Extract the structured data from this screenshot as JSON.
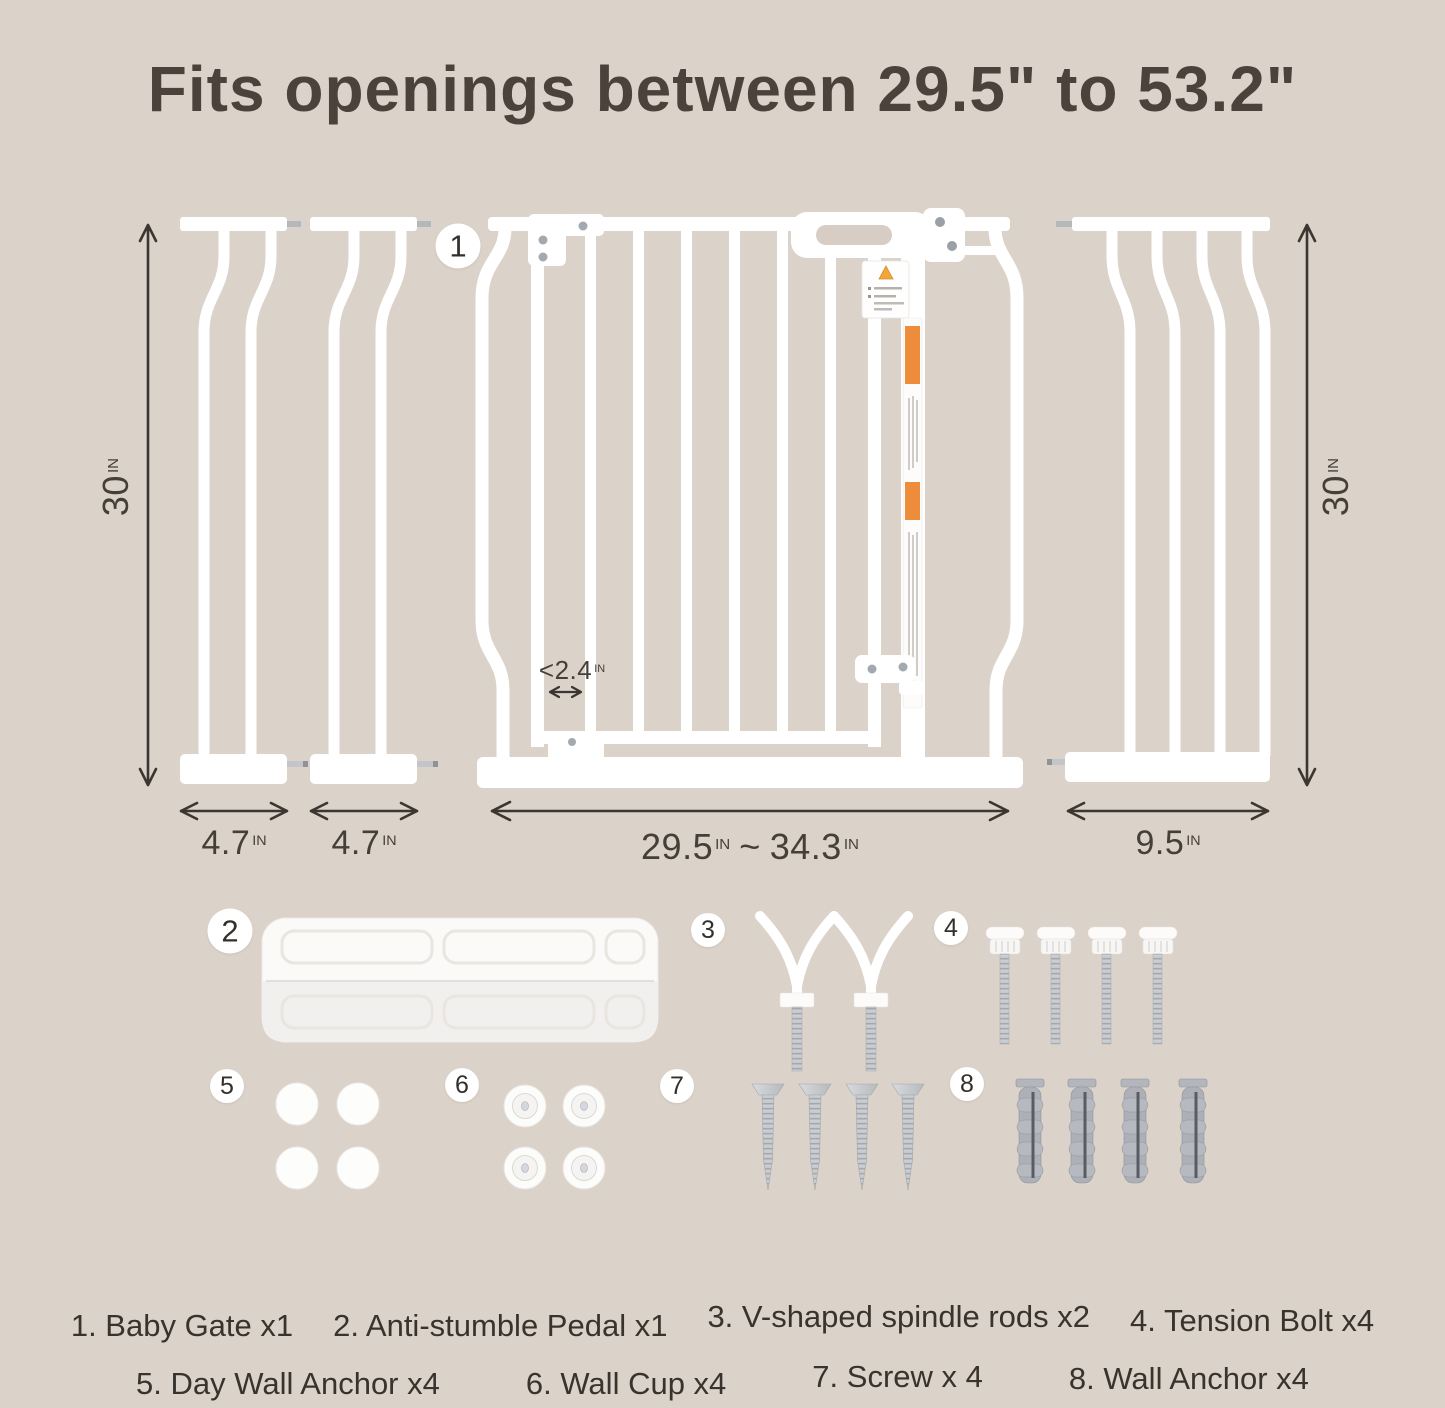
{
  "title": "Fits openings between 29.5\" to 53.2\"",
  "colors": {
    "background": "#dbd2c9",
    "title_text": "#4b433b",
    "dimension_text": "#453f38",
    "arrow": "#3b3631",
    "part_white": "#ffffff",
    "warning_orange": "#ed8c3a",
    "metal_gray": "#c4c7cb",
    "anchor_gray": "#adb0b7"
  },
  "badges": [
    "1",
    "2",
    "3",
    "4",
    "5",
    "6",
    "7",
    "8"
  ],
  "dimensions": {
    "height_left": {
      "value": "30",
      "unit": "IN"
    },
    "height_right": {
      "value": "30",
      "unit": "IN"
    },
    "ext_small_1": {
      "value": "4.7",
      "unit": "IN"
    },
    "ext_small_2": {
      "value": "4.7",
      "unit": "IN"
    },
    "gate_width": {
      "min": "29.5",
      "min_unit": "IN",
      "separator": "~",
      "max": "34.3",
      "max_unit": "IN"
    },
    "ext_large": {
      "value": "9.5",
      "unit": "IN"
    },
    "bar_gap": {
      "value": "<2.4",
      "unit": "IN"
    }
  },
  "legend": {
    "row1": [
      "1. Baby Gate x1",
      "2. Anti-stumble Pedal x1",
      "3. V-shaped spindle rods x2",
      "4. Tension Bolt x4"
    ],
    "row2": [
      "5. Day Wall Anchor x4",
      "6. Wall Cup x4",
      "7. Screw x 4",
      "8. Wall Anchor x4"
    ]
  }
}
